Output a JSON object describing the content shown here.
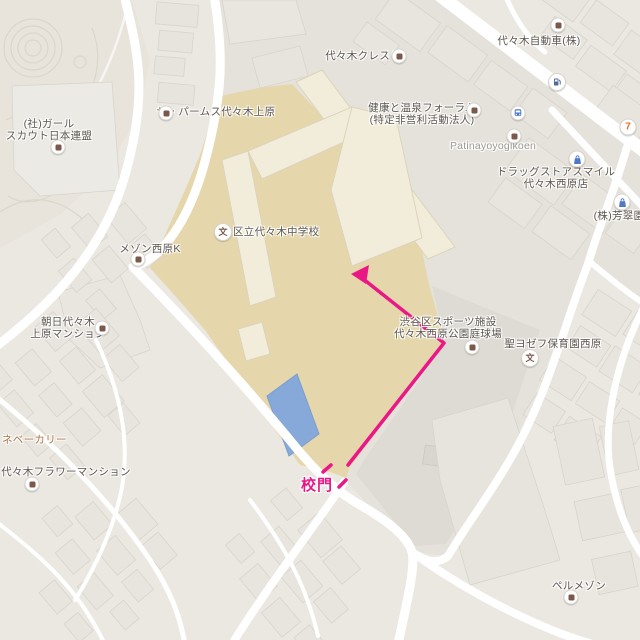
{
  "labels": {
    "crest": "代々木クレスト",
    "jidosha": "代々木自動車(株)",
    "girlscout1": "(社)ガール",
    "girlscout2": "スカウト日本連盟",
    "palms": "ザ・パームス代々木上原",
    "kenko1": "健康と温泉フォーラム",
    "kenko2": "(特定非営利活動法人)",
    "patina": "Patinayoyogikoen",
    "drug1": "ドラッグストアスマイル",
    "drug2": "代々木西原店",
    "hosuien": "(株)芳翠園",
    "school": "区立代々木中学校",
    "maison": "メゾン西原K",
    "asahi1": "朝日代々木",
    "asahi2": "上原マンション",
    "sports1": "渋谷区スポーツ施設",
    "sports2": "代々木西原公園庭球場",
    "joseph": "聖ヨゼフ保育園西原",
    "bakery": "ネベーカリー",
    "flower": "代々木フラワーマンション",
    "bell": "ペルメゾン",
    "komon": "校門",
    "school_glyph": "文",
    "seven_glyph": "7"
  },
  "route": {
    "gate_label": "校門",
    "color": "#ec1786",
    "path_points": [
      [
        348,
        465
      ],
      [
        444,
        343
      ],
      [
        362,
        278
      ]
    ],
    "arrow_tip": [
      351,
      274
    ],
    "dashes": [
      [
        [
          323,
          472
        ],
        [
          331,
          465
        ]
      ],
      [
        [
          339,
          487
        ],
        [
          346,
          480
        ]
      ]
    ]
  },
  "colors": {
    "base": "#ebe8e2",
    "park": "#e8e4dc",
    "road": "#ffffff",
    "gray_zone": "#e5e2db",
    "tennis_courts": "#dedbd4",
    "school_ground": "#e5d7ab",
    "school_building": "#f2eddb",
    "pool": "#86a9da",
    "route_pink": "#ec1786",
    "poi_brown": "#7b584a",
    "poi_blue": "#4f79c8",
    "label_default": "#5b564e",
    "label_latin": "#9d9991",
    "label_food": "#aa7442"
  }
}
